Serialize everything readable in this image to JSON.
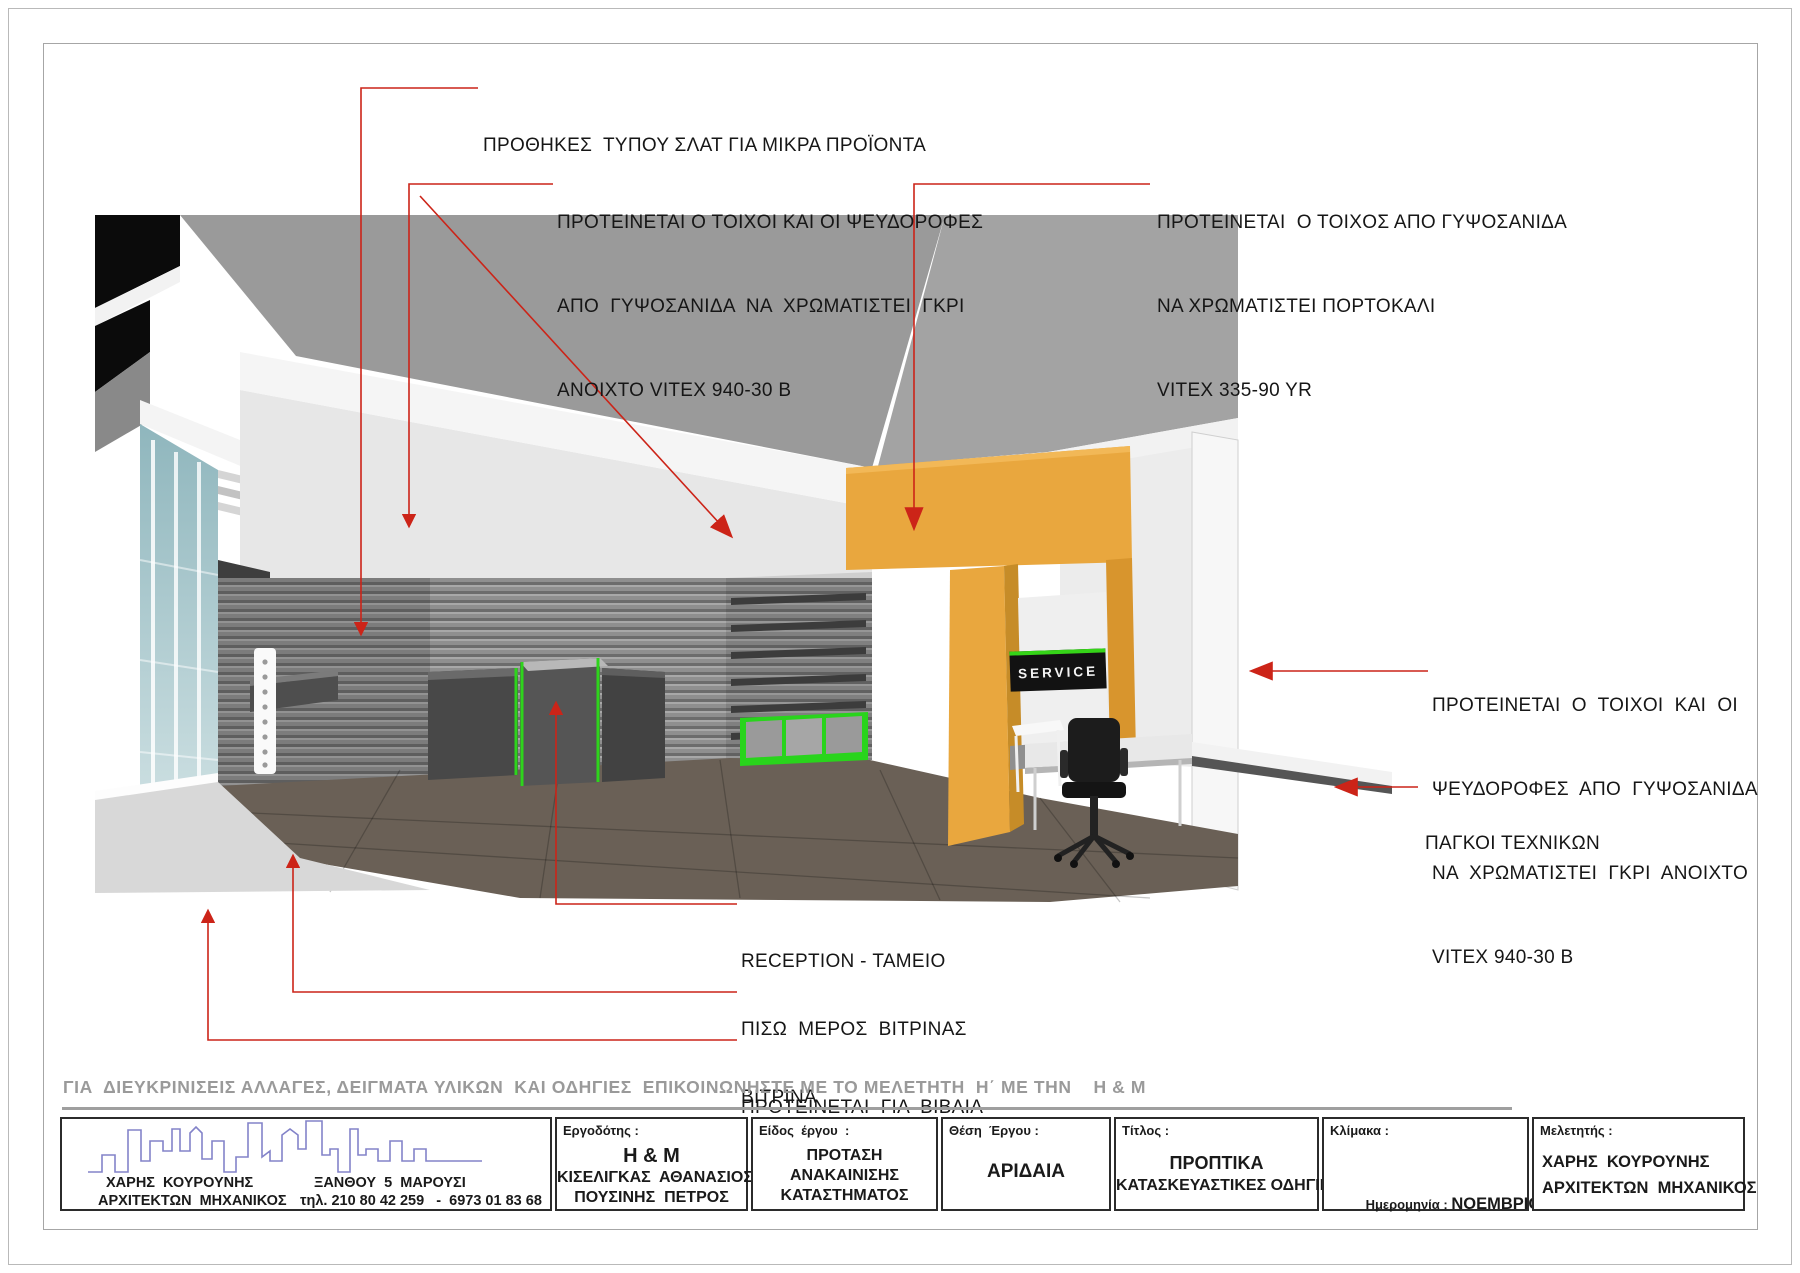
{
  "annotations": {
    "slat_showcases": "ΠΡΟΘΗΚΕΣ  ΤΥΠΟΥ ΣΛΑΤ ΓΙΑ ΜΙΚΡΑ ΠΡΟΪΟΝΤΑ",
    "gray_left": {
      "l1": "ΠΡΟΤΕΙΝΕΤΑΙ Ο ΤΟΙΧΟΙ ΚΑΙ ΟΙ ΨΕΥΔΟΡΟΦΕΣ",
      "l2": "ΑΠΟ  ΓΥΨΟΣΑΝΙΔΑ  ΝΑ  ΧΡΩΜΑΤΙΣΤΕΙ  ΓΚΡΙ",
      "l3": "ΑΝΟΙΧΤΟ VITEX 940-30 B"
    },
    "orange_wall": {
      "l1": "ΠΡΟΤΕΙΝΕΤΑΙ  Ο ΤΟΙΧΟΣ ΑΠΟ ΓΥΨΟΣΑΝΙΔΑ",
      "l2": "ΝΑ ΧΡΩΜΑΤΙΣΤΕΙ ΠΟΡΤΟΚΑΛΙ",
      "l3": "VITEX 335-90 YR"
    },
    "gray_right": {
      "l1": "ΠΡΟΤΕΙΝΕΤΑΙ  Ο  ΤΟΙΧΟΙ  ΚΑΙ  ΟΙ",
      "l2": "ΨΕΥΔΟΡΟΦΕΣ  ΑΠΟ  ΓΥΨΟΣΑΝΙΔΑ",
      "l3": "ΝΑ  ΧΡΩΜΑΤΙΣΤΕΙ  ΓΚΡΙ  ΑΝΟΙΧΤΟ",
      "l4": "VITEX 940-30 B"
    },
    "benches": "ΠΑΓΚΟΙ ΤΕΧΝΙΚΩΝ",
    "reception": "RECEPTION - ΤΑΜΕΙΟ",
    "window_back": {
      "l1": "ΠΙΣΩ  ΜΕΡΟΣ  ΒΙΤΡΙΝΑΣ",
      "l2": "ΠΡΟΤΕΙΝΕΤΑΙ  ΓΙΑ  ΒΙΒΛΙΑ"
    },
    "vitrina": "ΒΙΤΡΙΝΑ"
  },
  "scene": {
    "service_sign": "SERVICE"
  },
  "footer": {
    "note": "ΓΙΑ  ΔΙΕΥΚΡΙΝΙΣΕΙΣ ΑΛΛΑΓΕΣ, ΔΕΙΓΜΑΤΑ ΥΛΙΚΩΝ  ΚΑΙ ΟΔΗΓΙΕΣ  ΕΠΙΚΟΙΝΩΝΗΣΤΕ ΜΕ ΤΟ ΜΕΛΕΤΗΤΗ  Η΄ ΜΕ ΤΗΝ    Η & Μ"
  },
  "titleblock": {
    "firm": {
      "name": "ΧΑΡΗΣ  ΚΟΥΡΟΥΝΗΣ",
      "title": "ΑΡΧΙΤΕΚΤΩΝ  ΜΗΧΑΝΙΚΟΣ",
      "address": "ΞΑΝΘΟΥ  5  ΜΑΡΟΥΣΙ",
      "phone": "τηλ. 210 80 42 259   -  6973 01 83 68"
    },
    "client": {
      "label": "Εργοδότης :",
      "l1": "H & M",
      "l2": "ΚΙΣΕΛΙΓΚΑΣ  ΑΘΑΝΑΣΙΟΣ",
      "l3": "ΠΟΥΣΙΝΗΣ  ΠΕΤΡΟΣ"
    },
    "kind": {
      "label": "Είδος  έργου  :",
      "l1": "ΠΡΟΤΑΣΗ",
      "l2": "ΑΝΑΚΑΙΝΙΣΗΣ",
      "l3": "ΚΑΤΑΣΤΗΜΑΤΟΣ"
    },
    "location": {
      "label": "Θέση  Έργου :",
      "value": "ΑΡΙΔΑΙΑ"
    },
    "doc_title": {
      "label": "Τίτλος :",
      "l1": "ΠΡΟΠΤΙΚΑ",
      "l2": "ΚΑΤΑΣΚΕΥΑΣΤΙΚΕΣ ΟΔΗΓΙΕΣ"
    },
    "scale": {
      "label": "Κλίμακα :"
    },
    "date": {
      "label": "Ημερομηνία : ",
      "value": "ΝΟΕΜΒΡΙΟΣ  2009"
    },
    "designer": {
      "label": "Μελετητής :",
      "l1": "ΧΑΡΗΣ  ΚΟΥΡΟΥΝΗΣ",
      "l2": "ΑΡΧΙΤΕΚΤΩΝ  ΜΗΧΑΝΙΚΟΣ"
    }
  },
  "colors": {
    "arrow_red": "#cc2418",
    "orange_wall": "#e9a73e",
    "green_trim": "#2ed41c",
    "glass": "#9cc0c6"
  }
}
